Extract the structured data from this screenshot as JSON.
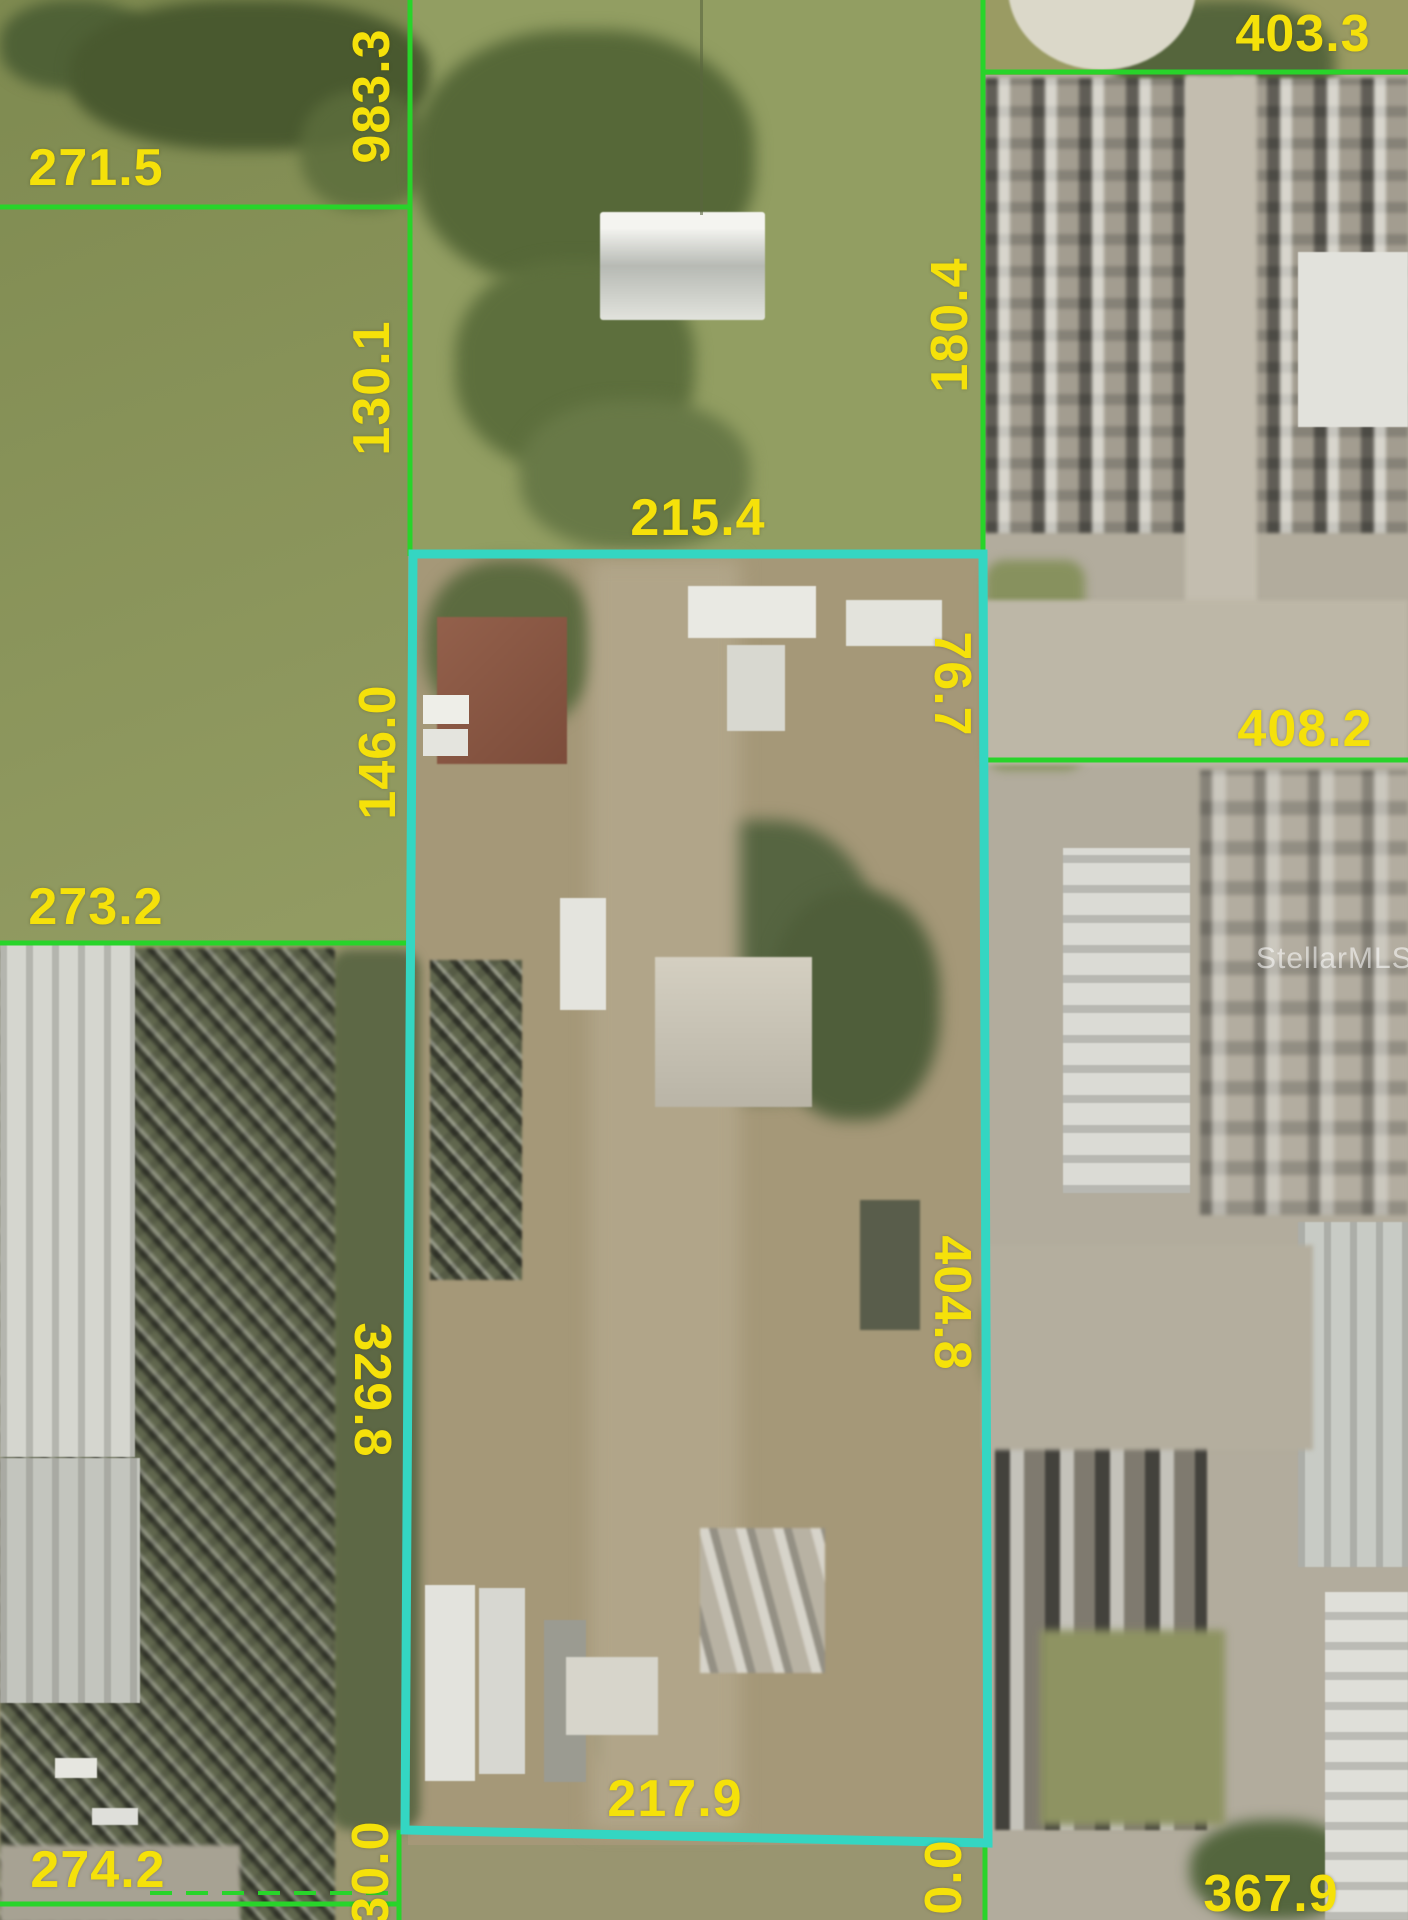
{
  "map": {
    "type": "aerial-parcel-boundary-map",
    "watermark": "StellarMLS",
    "colors": {
      "measurement_text": "#f5e10a",
      "parcel_highlight": "#34d6c2",
      "lot_line": "#28d42a"
    },
    "subject_parcel": {
      "top": "215.4",
      "right_upper": "76.7",
      "right_lower": "404.8",
      "bottom": "217.9",
      "left_upper": "146.0",
      "left_lower": "329.8"
    },
    "adjacent_measurements": {
      "top_left_width": "271.5",
      "left_boundary_upper": "983.3",
      "left_boundary_lower": "130.1",
      "mid_left_width": "273.2",
      "bottom_left_width": "274.2",
      "bottom_left_stub": "30.0",
      "top_right_width": "403.3",
      "right_boundary_upper": "180.4",
      "mid_right_width": "408.2",
      "bottom_right_stub": "0.0",
      "bottom_right_width": "367.9"
    }
  }
}
